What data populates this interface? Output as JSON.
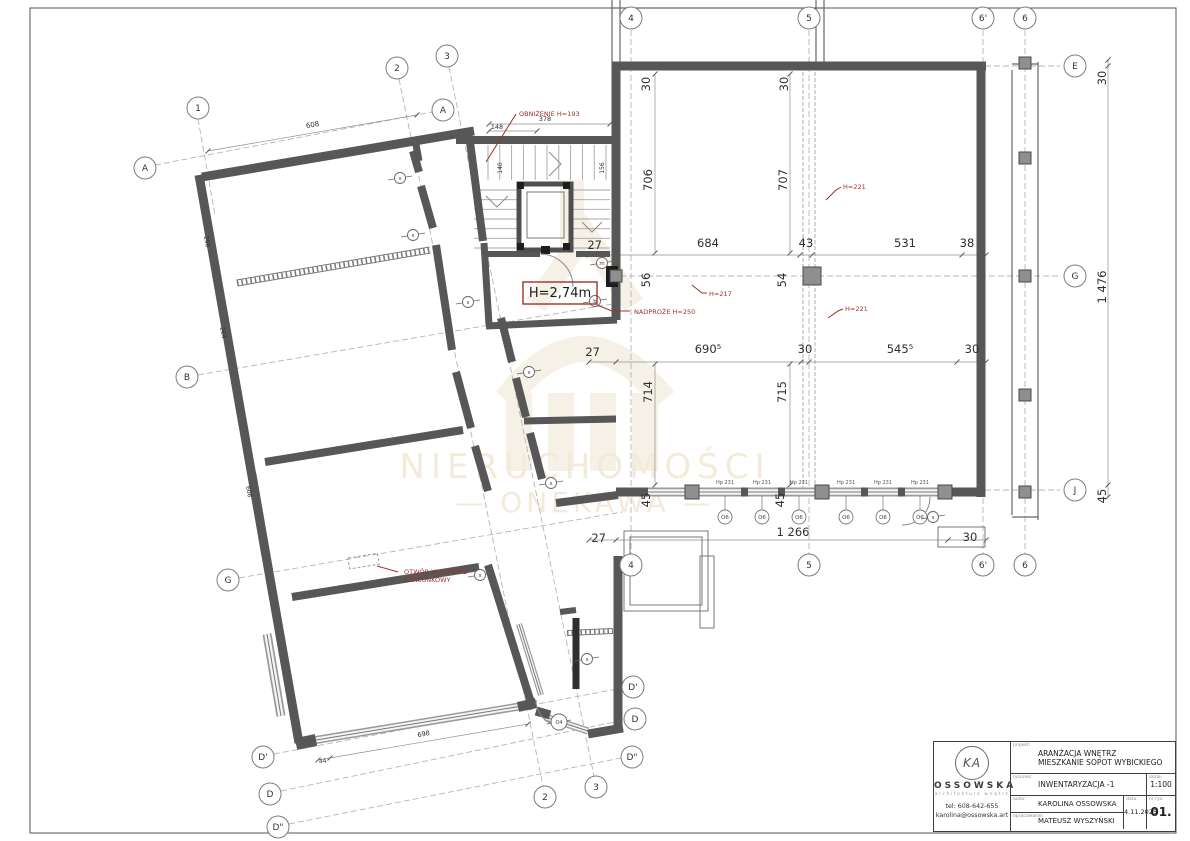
{
  "colors": {
    "wall": "#575757",
    "wallDark": "#2f2f2f",
    "line": "#8a8a8a",
    "axis": "#b5b5b5",
    "dim": "#2e2e2e",
    "red": "#a03028",
    "beige": "#ead9bd",
    "beige2": "#efe6d2",
    "column": "#8f8f8f",
    "glass": "#9a9a9a"
  },
  "watermark": {
    "line1": "NIERUCHOMOŚCI",
    "line2": "—   ONEKAWA   —"
  },
  "title_block": {
    "logo_monogram": "KA",
    "logo_name": "OSSOWSKA",
    "logo_sub": "architektura wnętrz",
    "tel": "tel: 608-642-655",
    "email": "karolina@ossowska.art",
    "projekt_label": "projekt:",
    "projekt_line1": "ARANŻACJA WNĘTRZ",
    "projekt_line2": "MIESZKANIE SOPOT WYBICKIEGO",
    "rysunek_label": "rysunek:",
    "rysunek": "INWENTARYZACJA -1",
    "skala_label": "skala:",
    "skala": "1:100",
    "autor_label": "autor:",
    "autor": "KAROLINA OSSOWSKA",
    "opracowanie_label": "opracowanie:",
    "opracowanie": "MATEUSZ WYSZYŃSKI",
    "data_label": "data:",
    "data": "4.11.2025",
    "nr_label": "nr rys:",
    "nr": "01."
  },
  "plan": {
    "frame": [
      30,
      8,
      1146,
      825
    ],
    "walls": [
      [
        202,
        177,
        474,
        131,
        9
      ],
      [
        199,
        175,
        299,
        743,
        9
      ],
      [
        415,
        139,
        419,
        161,
        7
      ],
      [
        456,
        140,
        614,
        140,
        8
      ],
      [
        470,
        142,
        483,
        241,
        8
      ],
      [
        484,
        243,
        489,
        325,
        7
      ],
      [
        486,
        326,
        617,
        320,
        7
      ],
      [
        501,
        318,
        512,
        362,
        8
      ],
      [
        516,
        378,
        526,
        417,
        8
      ],
      [
        524,
        421,
        616,
        419,
        7
      ],
      [
        530,
        433,
        542,
        479,
        8
      ],
      [
        556,
        503,
        618,
        495,
        8
      ],
      [
        488,
        565,
        533,
        709,
        8
      ],
      [
        292,
        597,
        479,
        567,
        8
      ],
      [
        265,
        462,
        463,
        430,
        8
      ],
      [
        413,
        151,
        419,
        172,
        8
      ],
      [
        421,
        186,
        433,
        228,
        8
      ],
      [
        436,
        245,
        452,
        350,
        8
      ],
      [
        456,
        372,
        471,
        428,
        8
      ],
      [
        475,
        446,
        488,
        491,
        8
      ],
      [
        487,
        254,
        540,
        254,
        6
      ],
      [
        576,
        254,
        610,
        254,
        6
      ],
      [
        616,
        62,
        616,
        320,
        9
      ],
      [
        618,
        556,
        618,
        728,
        9
      ],
      [
        588,
        734,
        623,
        728,
        9
      ],
      [
        536,
        711,
        550,
        715,
        9
      ],
      [
        560,
        612,
        576,
        610,
        6
      ],
      [
        576,
        618,
        576,
        689,
        7,
        "#2f2f2f"
      ],
      [
        296,
        744,
        316,
        740,
        12
      ],
      [
        518,
        707,
        536,
        703,
        10
      ],
      [
        612,
        66,
        986,
        66,
        9
      ],
      [
        981,
        62,
        981,
        497,
        9
      ],
      [
        616,
        492,
        648,
        492,
        9
      ],
      [
        950,
        492,
        981,
        492,
        9
      ],
      [
        741,
        492,
        748,
        492,
        9
      ],
      [
        778,
        492,
        785,
        492,
        9
      ],
      [
        861,
        492,
        868,
        492,
        9
      ],
      [
        898,
        492,
        905,
        492,
        9
      ]
    ],
    "windows": [
      [
        252,
        474,
        266,
        556,
        9
      ],
      [
        267,
        634,
        281,
        716,
        9
      ],
      [
        316,
        740,
        522,
        706,
        8
      ],
      [
        648,
        492,
        950,
        492,
        9
      ],
      [
        545,
        717,
        588,
        731,
        7
      ],
      [
        519,
        624,
        541,
        695,
        6
      ]
    ],
    "hatched": [
      [
        237,
        283,
        430,
        250,
        6
      ],
      [
        567,
        633,
        613,
        631,
        5
      ]
    ],
    "thin": [
      [
        612,
        0,
        612,
        62
      ],
      [
        620,
        0,
        620,
        62
      ],
      [
        816,
        0,
        816,
        62
      ],
      [
        824,
        0,
        824,
        62
      ],
      [
        612,
        8,
        824,
        8
      ],
      [
        1038,
        62,
        1038,
        520
      ],
      [
        1012,
        70,
        1012,
        515
      ],
      [
        1012,
        517,
        1038,
        517
      ],
      [
        1012,
        64,
        1038,
        64
      ]
    ],
    "rects": [
      [
        624,
        531,
        84,
        80
      ],
      [
        630,
        537,
        72,
        68
      ],
      [
        700,
        556,
        14,
        72
      ],
      [
        938,
        527,
        47,
        20
      ],
      [
        527,
        192,
        37,
        46
      ]
    ],
    "dashrect": [
      348,
      558,
      30,
      11,
      -9
    ],
    "elevator": [
      519,
      184,
      52,
      66
    ],
    "blacks": [
      [
        606,
        266,
        12,
        21
      ],
      [
        517,
        182,
        7,
        7
      ],
      [
        563,
        182,
        7,
        7
      ],
      [
        517,
        243,
        7,
        7
      ],
      [
        563,
        243,
        7,
        7
      ],
      [
        541,
        246,
        9,
        8
      ]
    ],
    "columns": [
      [
        1025,
        158,
        12
      ],
      [
        1025,
        276,
        12
      ],
      [
        1025,
        395,
        12
      ],
      [
        1025,
        492,
        12
      ],
      [
        1025,
        63,
        12
      ],
      [
        812,
        276,
        18
      ],
      [
        692,
        492,
        14
      ],
      [
        822,
        492,
        14
      ],
      [
        945,
        492,
        14
      ],
      [
        616,
        276,
        12
      ]
    ],
    "dashpairs": [
      [
        803,
        72,
        803,
        488
      ],
      [
        815,
        72,
        815,
        488
      ]
    ],
    "axes": [
      [
        631,
        30,
        631,
        555
      ],
      [
        809,
        30,
        809,
        555
      ],
      [
        983,
        30,
        983,
        555
      ],
      [
        1025,
        30,
        1025,
        555
      ],
      [
        940,
        66,
        1060,
        66
      ],
      [
        620,
        276,
        1060,
        276
      ],
      [
        625,
        490,
        1060,
        490
      ],
      [
        155,
        165,
        432,
        112
      ],
      [
        198,
        119,
        215,
        215
      ],
      [
        399,
        79,
        543,
        786
      ],
      [
        449,
        67,
        594,
        776
      ],
      [
        198,
        375,
        618,
        303
      ],
      [
        239,
        578,
        622,
        512
      ],
      [
        274,
        754,
        622,
        688
      ],
      [
        281,
        791,
        624,
        720
      ],
      [
        289,
        824,
        621,
        758
      ]
    ],
    "dimlines": [
      [
        589,
        255,
        986,
        255
      ],
      [
        589,
        362,
        986,
        362
      ],
      [
        589,
        540,
        986,
        540
      ],
      [
        655,
        74,
        655,
        253
      ],
      [
        790,
        74,
        790,
        253
      ],
      [
        655,
        364,
        655,
        485
      ],
      [
        790,
        364,
        790,
        485
      ],
      [
        1108,
        60,
        1108,
        497
      ],
      [
        489,
        124,
        610,
        124
      ],
      [
        489,
        131,
        537,
        131
      ],
      [
        208,
        151,
        417,
        115
      ],
      [
        318,
        760,
        528,
        724
      ]
    ],
    "ticks": [
      [
        589,
        255
      ],
      [
        616,
        255
      ],
      [
        800,
        255
      ],
      [
        812,
        255
      ],
      [
        962,
        255
      ],
      [
        986,
        255
      ],
      [
        589,
        362
      ],
      [
        616,
        362
      ],
      [
        801,
        362
      ],
      [
        809,
        362
      ],
      [
        957,
        362
      ],
      [
        986,
        362
      ],
      [
        589,
        540
      ],
      [
        616,
        540
      ],
      [
        948,
        540
      ],
      [
        986,
        540
      ],
      [
        655,
        74
      ],
      [
        655,
        253
      ],
      [
        790,
        74
      ],
      [
        790,
        253
      ],
      [
        655,
        364
      ],
      [
        655,
        485
      ],
      [
        790,
        364
      ],
      [
        790,
        485
      ],
      [
        1108,
        60
      ],
      [
        1108,
        66
      ],
      [
        1108,
        485
      ],
      [
        1108,
        497
      ],
      [
        489,
        124
      ],
      [
        610,
        124
      ],
      [
        489,
        131
      ],
      [
        537,
        131
      ],
      [
        208,
        151
      ],
      [
        417,
        115
      ],
      [
        318,
        760
      ],
      [
        528,
        724
      ],
      [
        330,
        758
      ]
    ],
    "stairs": {
      "upper": {
        "x0": 488,
        "x1": 606,
        "y0": 145,
        "y1": 180,
        "n": 10
      },
      "left": {
        "x0": 474,
        "x1": 517,
        "y0": 190,
        "y1": 248,
        "n": 6
      },
      "right": {
        "x0": 573,
        "x1": 610,
        "y0": 190,
        "y1": 248,
        "n": 6
      }
    },
    "chevrons": [
      [
        549,
        152,
        561,
        164,
        549,
        176
      ],
      [
        486,
        196,
        497,
        207,
        508,
        196
      ],
      [
        582,
        222,
        592,
        232,
        602,
        222
      ]
    ],
    "paths": [
      "M540,254 A33,33 0 0 1 573,287",
      "M536,700 A26,26 0 0 0 562,726",
      "M930,497 A28,28 0 0 1 902,525"
    ],
    "dims": [
      {
        "t": "27",
        "x": 602,
        "y": 249,
        "a": "end"
      },
      {
        "t": "684",
        "x": 708,
        "y": 247
      },
      {
        "t": "43",
        "x": 806,
        "y": 247
      },
      {
        "t": "531",
        "x": 905,
        "y": 247
      },
      {
        "t": "38",
        "x": 967,
        "y": 247
      },
      {
        "t": "706",
        "x": 652,
        "y": 180,
        "r": -90
      },
      {
        "t": "707",
        "x": 787,
        "y": 180,
        "r": -90
      },
      {
        "t": "56",
        "x": 650,
        "y": 280,
        "r": -90
      },
      {
        "t": "54",
        "x": 786,
        "y": 280,
        "r": -90
      },
      {
        "t": "27",
        "x": 600,
        "y": 356,
        "a": "end"
      },
      {
        "t": "690⁵",
        "x": 708,
        "y": 353
      },
      {
        "t": "30",
        "x": 805,
        "y": 353
      },
      {
        "t": "545⁵",
        "x": 900,
        "y": 353
      },
      {
        "t": "30",
        "x": 972,
        "y": 353
      },
      {
        "t": "714",
        "x": 652,
        "y": 392,
        "r": -90
      },
      {
        "t": "715",
        "x": 786,
        "y": 392,
        "r": -90
      },
      {
        "t": "45",
        "x": 650,
        "y": 500,
        "r": -90
      },
      {
        "t": "45",
        "x": 784,
        "y": 500,
        "r": -90
      },
      {
        "t": "27",
        "x": 606,
        "y": 542,
        "a": "end"
      },
      {
        "t": "1 266",
        "x": 793,
        "y": 536
      },
      {
        "t": "30",
        "x": 970,
        "y": 541
      },
      {
        "t": "30",
        "x": 650,
        "y": 84,
        "r": -90
      },
      {
        "t": "30",
        "x": 788,
        "y": 84,
        "r": -90
      },
      {
        "t": "30",
        "x": 1106,
        "y": 78,
        "r": -90
      },
      {
        "t": "1 476",
        "x": 1106,
        "y": 287,
        "r": -90
      },
      {
        "t": "45",
        "x": 1106,
        "y": 496,
        "r": -90
      },
      {
        "t": "378",
        "x": 545,
        "y": 121,
        "s": 6.5
      },
      {
        "t": "148",
        "x": 497,
        "y": 129,
        "s": 6.5
      },
      {
        "t": "140",
        "x": 502,
        "y": 168,
        "s": 6,
        "r": -90
      },
      {
        "t": "156",
        "x": 604,
        "y": 168,
        "s": 6,
        "r": -90
      },
      {
        "t": "608",
        "x": 313,
        "y": 127,
        "s": 7,
        "r": -10
      },
      {
        "t": "250",
        "x": 205,
        "y": 242,
        "s": 6,
        "r": 80
      },
      {
        "t": "264",
        "x": 221,
        "y": 333,
        "s": 6,
        "r": 80
      },
      {
        "t": "606",
        "x": 247,
        "y": 492,
        "s": 6,
        "r": 80
      },
      {
        "t": "698",
        "x": 424,
        "y": 736,
        "s": 6.5,
        "r": -10
      },
      {
        "t": "44",
        "x": 323,
        "y": 763,
        "s": 6,
        "r": -10
      }
    ],
    "bubbles": [
      {
        "t": "1",
        "x": 198,
        "y": 108
      },
      {
        "t": "2",
        "x": 397,
        "y": 68
      },
      {
        "t": "3",
        "x": 447,
        "y": 56
      },
      {
        "t": "A",
        "x": 145,
        "y": 168
      },
      {
        "t": "A",
        "x": 443,
        "y": 110
      },
      {
        "t": "4",
        "x": 631,
        "y": 18
      },
      {
        "t": "5",
        "x": 809,
        "y": 18
      },
      {
        "t": "6'",
        "x": 983,
        "y": 18
      },
      {
        "t": "6",
        "x": 1025,
        "y": 18
      },
      {
        "t": "E",
        "x": 1075,
        "y": 66
      },
      {
        "t": "G",
        "x": 1075,
        "y": 276
      },
      {
        "t": "J",
        "x": 1075,
        "y": 490
      },
      {
        "t": "B",
        "x": 187,
        "y": 377
      },
      {
        "t": "G",
        "x": 228,
        "y": 580
      },
      {
        "t": "D'",
        "x": 263,
        "y": 757
      },
      {
        "t": "D",
        "x": 270,
        "y": 794
      },
      {
        "t": "D\"",
        "x": 278,
        "y": 827
      },
      {
        "t": "4",
        "x": 631,
        "y": 565
      },
      {
        "t": "5",
        "x": 809,
        "y": 565
      },
      {
        "t": "6'",
        "x": 983,
        "y": 565
      },
      {
        "t": "6",
        "x": 1025,
        "y": 565
      },
      {
        "t": "2",
        "x": 545,
        "y": 797
      },
      {
        "t": "3",
        "x": 596,
        "y": 787
      },
      {
        "t": "D'",
        "x": 633,
        "y": 687
      },
      {
        "t": "D",
        "x": 635,
        "y": 719
      },
      {
        "t": "D\"",
        "x": 632,
        "y": 757
      }
    ],
    "markers": [
      {
        "t": "s",
        "x": 400,
        "y": 178
      },
      {
        "t": "s",
        "x": 413,
        "y": 235
      },
      {
        "t": "s",
        "x": 468,
        "y": 302
      },
      {
        "t": "s",
        "x": 529,
        "y": 372
      },
      {
        "t": "s",
        "x": 551,
        "y": 483
      },
      {
        "t": "s",
        "x": 480,
        "y": 575
      },
      {
        "t": "s",
        "x": 587,
        "y": 659
      },
      {
        "t": "s",
        "x": 933,
        "y": 517
      },
      {
        "t": "m",
        "x": 602,
        "y": 263
      },
      {
        "t": "b",
        "x": 595,
        "y": 301
      },
      {
        "t": "O4",
        "x": 559,
        "y": 722,
        "r": 8
      }
    ],
    "window_tags": {
      "label": "Hp 231",
      "circle": "O6",
      "y_label": 484,
      "y_circle": 517,
      "y_wall": 496,
      "xs": [
        725,
        762,
        799,
        846,
        883,
        920
      ]
    },
    "reds": [
      {
        "t": "OBNIŻENIE H=193",
        "x": 519,
        "y": 116,
        "s": 6.5,
        "a": "start"
      },
      {
        "t": "NADPROŻE H=250",
        "x": 634,
        "y": 314,
        "s": 6.5,
        "a": "start"
      },
      {
        "t": "H=217",
        "x": 709,
        "y": 296,
        "s": 6.5,
        "a": "start"
      },
      {
        "t": "H=221",
        "x": 843,
        "y": 189,
        "s": 6.5,
        "a": "start"
      },
      {
        "t": "H=221",
        "x": 845,
        "y": 311,
        "s": 6.5,
        "a": "start"
      },
      {
        "t": "OTWÓR W STROPIE",
        "x": 404,
        "y": 574,
        "s": 6.5,
        "a": "start"
      },
      {
        "t": "SZACUNKOWY",
        "x": 404,
        "y": 582,
        "s": 6.5,
        "a": "start"
      }
    ],
    "red_box": {
      "x": 523,
      "y": 282,
      "w": 74,
      "h": 22,
      "t": "H=2,74m",
      "tx": 560,
      "ty": 297
    },
    "red_leaders": [
      [
        486,
        162,
        516,
        114
      ],
      [
        597,
        305,
        612,
        311,
        630,
        311
      ],
      [
        692,
        285,
        702,
        293,
        707,
        293
      ],
      [
        826,
        200,
        836,
        190,
        841,
        187
      ],
      [
        828,
        318,
        838,
        311,
        843,
        309
      ],
      [
        377,
        566,
        398,
        572
      ]
    ]
  }
}
